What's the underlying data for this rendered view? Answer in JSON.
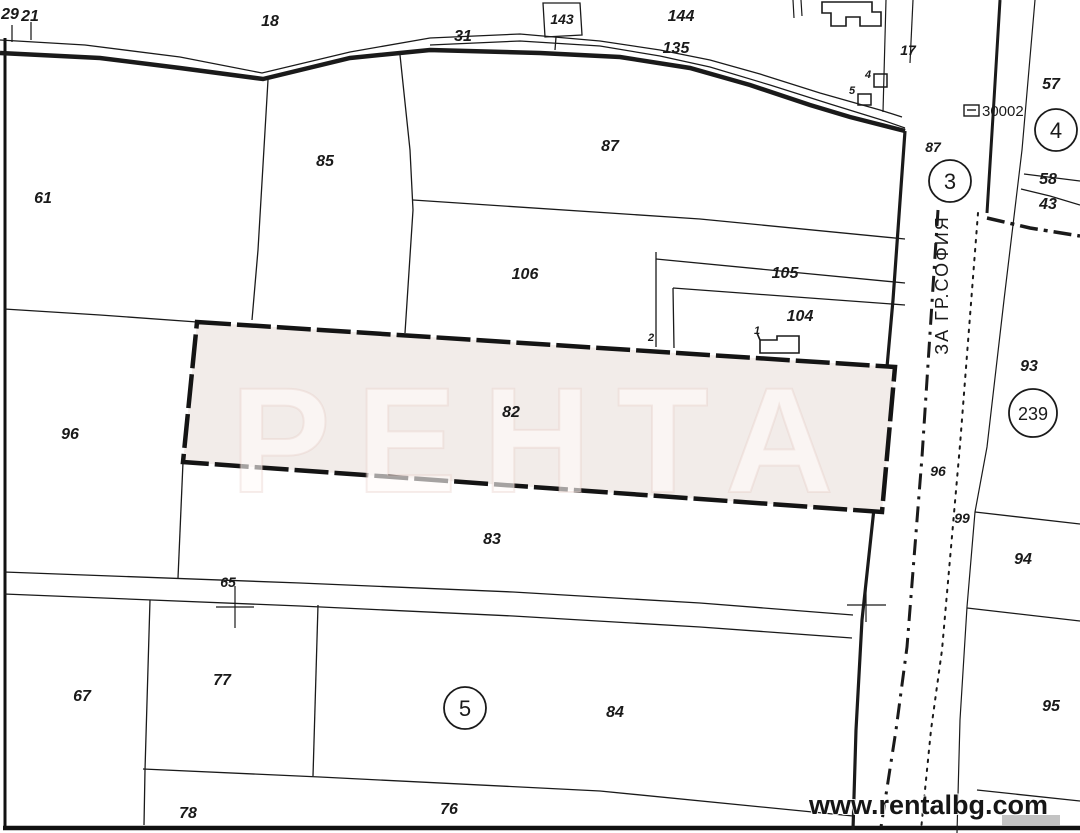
{
  "map": {
    "type": "cadastral-plan",
    "highlighted_parcel": {
      "label": "82",
      "fill": "#f2ece9",
      "border": "#141414"
    },
    "road_name": "ЗА ГР.СОФИЯ",
    "watermark": "РЕНТА",
    "website": "www.rentalbg.com",
    "code_label": "30002",
    "line_color": "#1a1a1a",
    "labels": {
      "corner_29": "29",
      "corner_21": "21",
      "p18": "18",
      "p31": "31",
      "p143": "143",
      "p144": "144",
      "p135": "135",
      "p17": "17",
      "b4": "4",
      "b5": "5",
      "p87": "87",
      "p87_road": "87",
      "p85": "85",
      "p61": "61",
      "p106": "106",
      "p105": "105",
      "p104": "104",
      "p57": "57",
      "p58": "58",
      "p43": "43",
      "p93": "93",
      "p2": "2",
      "b1": "1",
      "p82": "82",
      "p96": "96",
      "p96_road": "96",
      "p99": "99",
      "p94": "94",
      "p95": "95",
      "p83": "83",
      "p65": "65",
      "p67": "67",
      "p77": "77",
      "p84": "84",
      "p78": "78",
      "p76": "76"
    },
    "circled_numbers": {
      "c3": "3",
      "c4": "4",
      "c5": "5",
      "c239": "239"
    }
  }
}
